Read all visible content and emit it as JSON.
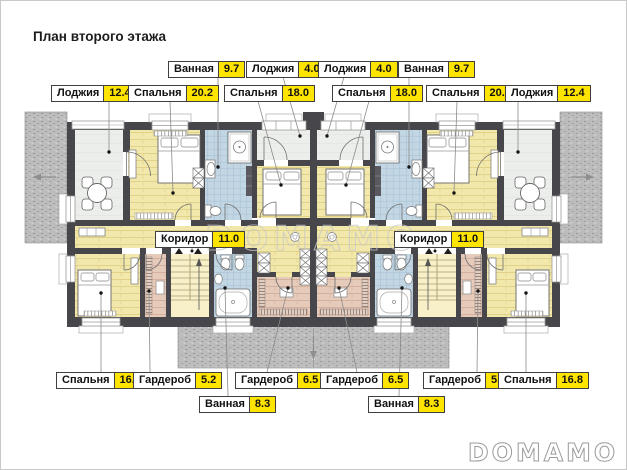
{
  "title": "План второго этажа",
  "watermark": "DOMAMO",
  "brand_logo": "DOMAMO",
  "colors": {
    "area_badge": "#ffe400",
    "walls": "#47464b",
    "bedroom_floor": "#f2e8ab",
    "bathroom_tile": "#c2d6e3",
    "wardrobe_floor": "#e6cbbb",
    "loggia_floor": "#eceeeb",
    "roof_hatch": "#bcbcbc"
  },
  "labels": [
    {
      "name": "Ванная",
      "area": "9.7"
    },
    {
      "name": "Лоджия",
      "area": "4.0"
    },
    {
      "name": "Лоджия",
      "area": "4.0"
    },
    {
      "name": "Ванная",
      "area": "9.7"
    },
    {
      "name": "Лоджия",
      "area": "12.4"
    },
    {
      "name": "Спальня",
      "area": "20.2"
    },
    {
      "name": "Спальня",
      "area": "18.0"
    },
    {
      "name": "Спальня",
      "area": "18.0"
    },
    {
      "name": "Спальня",
      "area": "20.2"
    },
    {
      "name": "Лоджия",
      "area": "12.4"
    },
    {
      "name": "Коридор",
      "area": "11.0"
    },
    {
      "name": "Коридор",
      "area": "11.0"
    },
    {
      "name": "Спальня",
      "area": "16.8"
    },
    {
      "name": "Гардероб",
      "area": "5.2"
    },
    {
      "name": "Гардероб",
      "area": "6.5"
    },
    {
      "name": "Гардероб",
      "area": "6.5"
    },
    {
      "name": "Гардероб",
      "area": "5.2"
    },
    {
      "name": "Спальня",
      "area": "16.8"
    },
    {
      "name": "Ванная",
      "area": "8.3"
    },
    {
      "name": "Ванная",
      "area": "8.3"
    }
  ]
}
